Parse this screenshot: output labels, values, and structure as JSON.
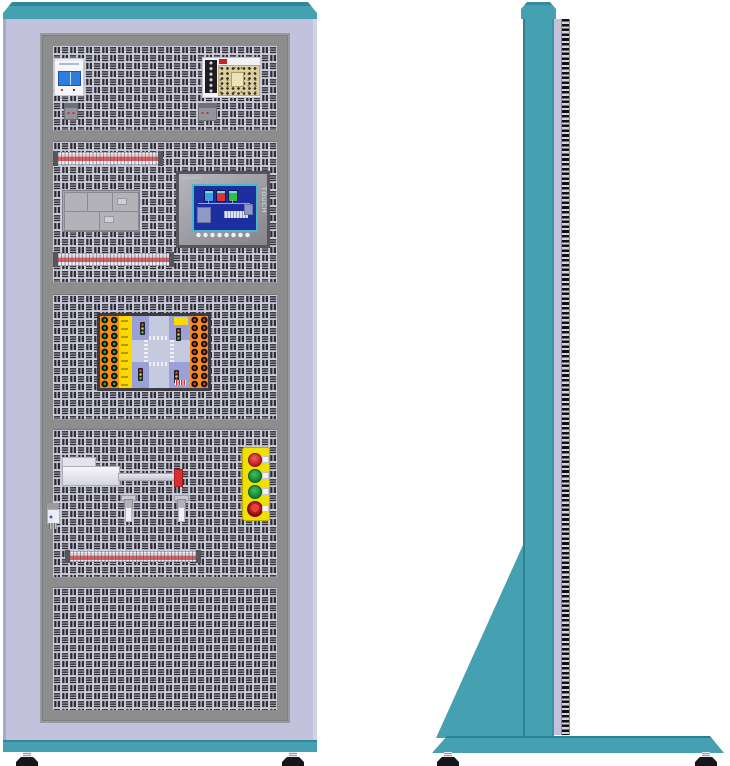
{
  "hmi": {
    "brand_label": "SIEMENS",
    "side_label": "TOUCH",
    "screen_color": "#1d2f9e",
    "screen_tanks": [
      {
        "name": "tank-1",
        "color": "#3aa0e8"
      },
      {
        "name": "tank-2",
        "color": "#e03030"
      },
      {
        "name": "tank-3",
        "color": "#30c040"
      }
    ],
    "function_key_count": 8
  },
  "front_view": {
    "sections": [
      {
        "name": "power-section",
        "components": [
          "circuit-breaker",
          "switching-power-supply",
          "rail-clamp",
          "rail-clamp"
        ]
      },
      {
        "name": "control-section",
        "components": [
          "terminal-rail",
          "plc-module-block",
          "hmi-touch-panel",
          "terminal-rail"
        ]
      },
      {
        "name": "simulation-section",
        "components": [
          "traffic-intersection-training-board"
        ]
      },
      {
        "name": "actuator-section",
        "components": [
          "pneumatic-cylinder",
          "relay-module",
          "proximity-sensor",
          "proximity-sensor",
          "push-button-station",
          "terminal-rail"
        ]
      },
      {
        "name": "empty-section",
        "components": []
      }
    ],
    "push_button_station": {
      "body_color": "#f0e000",
      "buttons": [
        {
          "name": "red-push-button",
          "color": "#c01818"
        },
        {
          "name": "green-push-button-1",
          "color": "#108030"
        },
        {
          "name": "green-push-button-2",
          "color": "#108030"
        },
        {
          "name": "emergency-stop-button",
          "color": "#8a0e0e"
        }
      ]
    },
    "traffic_board": {
      "left_terminal_color": "#18b038",
      "right_terminal_color": "#e03030",
      "terminal_rows": 9,
      "terminal_columns": 2,
      "strip_color": "#f08c1e",
      "label_strip_color": "#ffd800",
      "field_color": "#9aa0d8",
      "traffic_light_count": 4
    },
    "breaker": {
      "toggle_color": "#2b7de0",
      "pole_count": 2
    },
    "cylinder": {
      "tip_color": "#d83030"
    },
    "terminal_rail_stripe_color": "#d86060"
  },
  "side_view": {
    "components": [
      "top-cap",
      "column",
      "mounting-tooth-strip",
      "gusset-support",
      "base-plate",
      "leveling-foot",
      "leveling-foot"
    ]
  },
  "palette": {
    "teal": "#45a0b2",
    "teal_dark": "#2f8599",
    "lavender": "#c2c2dc",
    "frame_gray": "#8d8d8d",
    "panel_light": "#cdcdde",
    "panel_dark": "#2c2c32"
  }
}
